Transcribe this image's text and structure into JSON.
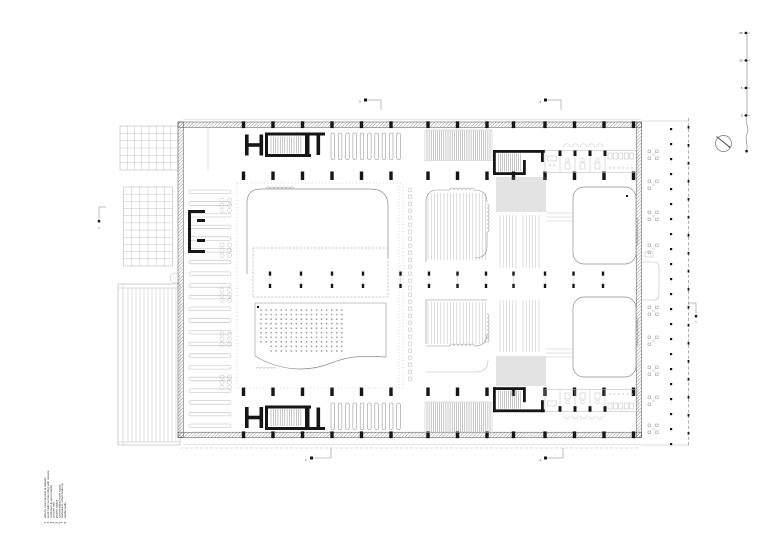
{
  "sheet": {
    "width": 780,
    "height": 551,
    "background": "#ffffff"
  },
  "palette": {
    "hairline": "#bcbcbc",
    "line": "#8f8f8f",
    "dark": "#4d4d4d",
    "wall": "#161616",
    "seat": "#9a9a9a"
  },
  "legend": {
    "items": [
      {
        "num": "1",
        "label": "atrium, internal park & debate"
      },
      {
        "num": "2",
        "label": "work halls surrounding with square"
      },
      {
        "num": "3",
        "label": "collection & open stacks"
      },
      {
        "num": "4",
        "label": "concert hall"
      },
      {
        "num": "5",
        "label": "project space"
      },
      {
        "num": "6",
        "label": "concentrated work spots"
      },
      {
        "num": "7",
        "label": "restaurant, urban balcony"
      },
      {
        "num": "8",
        "label": "textile walls"
      }
    ]
  },
  "scale_bar": {
    "labels": [
      "25",
      "10",
      "5",
      "0"
    ]
  },
  "section_markers": {
    "top_left": "b",
    "top_right": "a",
    "bottom_left": "b",
    "bottom_right": "a",
    "left": "c",
    "right": "c"
  },
  "compass": {
    "icon": "north-arrow-icon"
  }
}
